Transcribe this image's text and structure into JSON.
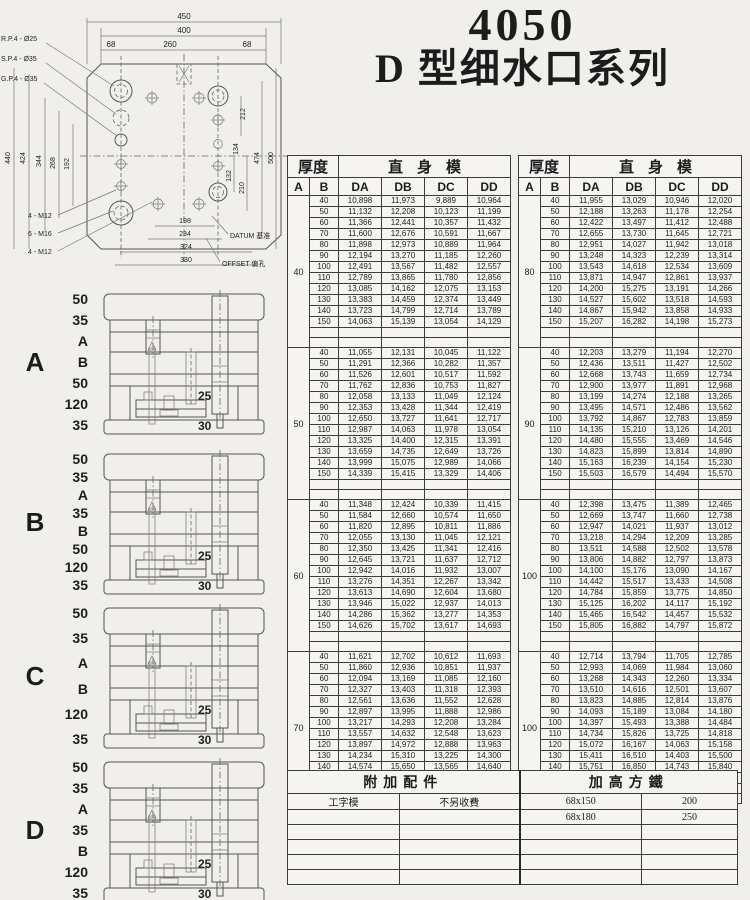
{
  "page": {
    "title_model": "4050",
    "title_series": "D 型细水口系列"
  },
  "drawing": {
    "pin_labels": [
      "R.P.4 - Ø25",
      "S.P.4 - Ø35",
      "G.P.4 - Ø35"
    ],
    "dims_top": [
      "450",
      "400",
      "68",
      "260",
      "68"
    ],
    "dims_left": [
      "440",
      "424",
      "344",
      "268",
      "192"
    ],
    "dims_right": [
      "212",
      "134",
      "132",
      "210",
      "474",
      "500"
    ],
    "dims_bottom": [
      "198",
      "234",
      "324",
      "330"
    ],
    "thread_labels": [
      "4 - M12",
      "6 - M16",
      "4 - M12"
    ],
    "label_datum": "DATUM 基准",
    "label_offset": "OFFSET 偏孔"
  },
  "sections": [
    {
      "letter": "A",
      "dims": [
        "50",
        "35",
        "A",
        "B",
        "50",
        "120",
        "35"
      ],
      "inner": [
        "25",
        "30"
      ]
    },
    {
      "letter": "B",
      "dims": [
        "50",
        "35",
        "A",
        "35",
        "B",
        "50",
        "120",
        "35"
      ],
      "inner": [
        "25",
        "30"
      ]
    },
    {
      "letter": "C",
      "dims": [
        "50",
        "35",
        "A",
        "B",
        "120",
        "35"
      ],
      "inner": [
        "25",
        "30"
      ]
    },
    {
      "letter": "D",
      "dims": [
        "50",
        "35",
        "A",
        "35",
        "B",
        "120",
        "35"
      ],
      "inner": [
        "25",
        "30"
      ]
    }
  ],
  "tables": {
    "header_thickness": "厚度",
    "header_straight": "直身模",
    "col_a": "A",
    "col_b": "B",
    "col_da": "DA",
    "col_db": "DB",
    "col_dc": "DC",
    "col_dd": "DD",
    "left_groups": [
      {
        "a": "40",
        "rows": [
          [
            "40",
            "10,898",
            "11,973",
            "9,889",
            "10,964"
          ],
          [
            "50",
            "11,132",
            "12,208",
            "10,123",
            "11,199"
          ],
          [
            "60",
            "11,366",
            "12,441",
            "10,357",
            "11,432"
          ],
          [
            "70",
            "11,600",
            "12,676",
            "10,591",
            "11,667"
          ],
          [
            "80",
            "11,898",
            "12,973",
            "10,889",
            "11,964"
          ],
          [
            "90",
            "12,194",
            "13,270",
            "11,185",
            "12,260"
          ],
          [
            "100",
            "12,491",
            "13,567",
            "11,482",
            "12,557"
          ],
          [
            "110",
            "12,789",
            "13,865",
            "11,780",
            "12,856"
          ],
          [
            "120",
            "13,085",
            "14,162",
            "12,075",
            "13,153"
          ],
          [
            "130",
            "13,383",
            "14,459",
            "12,374",
            "13,449"
          ],
          [
            "140",
            "13,723",
            "14,799",
            "12,714",
            "13,789"
          ],
          [
            "150",
            "14,063",
            "15,139",
            "13,054",
            "14,129"
          ]
        ]
      },
      {
        "a": "50",
        "rows": [
          [
            "40",
            "11,055",
            "12,131",
            "10,045",
            "11,122"
          ],
          [
            "50",
            "11,291",
            "12,366",
            "10,282",
            "11,357"
          ],
          [
            "60",
            "11,526",
            "12,601",
            "10,517",
            "11,592"
          ],
          [
            "70",
            "11,762",
            "12,836",
            "10,753",
            "11,827"
          ],
          [
            "80",
            "12,058",
            "13,133",
            "11,049",
            "12,124"
          ],
          [
            "90",
            "12,353",
            "13,428",
            "11,344",
            "12,419"
          ],
          [
            "100",
            "12,650",
            "13,727",
            "11,641",
            "12,717"
          ],
          [
            "110",
            "12,987",
            "14,063",
            "11,978",
            "13,054"
          ],
          [
            "120",
            "13,325",
            "14,400",
            "12,315",
            "13,391"
          ],
          [
            "130",
            "13,659",
            "14,735",
            "12,649",
            "13,726"
          ],
          [
            "140",
            "13,999",
            "15,075",
            "12,989",
            "14,066"
          ],
          [
            "150",
            "14,339",
            "15,415",
            "13,329",
            "14,406"
          ]
        ]
      },
      {
        "a": "60",
        "rows": [
          [
            "40",
            "11,348",
            "12,424",
            "10,339",
            "11,415"
          ],
          [
            "50",
            "11,584",
            "12,660",
            "10,574",
            "11,650"
          ],
          [
            "60",
            "11,820",
            "12,895",
            "10,811",
            "11,886"
          ],
          [
            "70",
            "12,055",
            "13,130",
            "11,045",
            "12,121"
          ],
          [
            "80",
            "12,350",
            "13,425",
            "11,341",
            "12,416"
          ],
          [
            "90",
            "12,645",
            "13,721",
            "11,637",
            "12,712"
          ],
          [
            "100",
            "12,942",
            "14,016",
            "11,932",
            "13,007"
          ],
          [
            "110",
            "13,276",
            "14,351",
            "12,267",
            "13,342"
          ],
          [
            "120",
            "13,613",
            "14,690",
            "12,604",
            "13,680"
          ],
          [
            "130",
            "13,946",
            "15,022",
            "12,937",
            "14,013"
          ],
          [
            "140",
            "14,286",
            "15,362",
            "13,277",
            "14,353"
          ],
          [
            "150",
            "14,626",
            "15,702",
            "13,617",
            "14,693"
          ]
        ]
      },
      {
        "a": "70",
        "rows": [
          [
            "40",
            "11,621",
            "12,702",
            "10,612",
            "11,693"
          ],
          [
            "50",
            "11,860",
            "12,936",
            "10,851",
            "11,937"
          ],
          [
            "60",
            "12,094",
            "13,169",
            "11,085",
            "12,160"
          ],
          [
            "70",
            "12,327",
            "13,403",
            "11,318",
            "12,393"
          ],
          [
            "80",
            "12,561",
            "13,636",
            "11,552",
            "12,628"
          ],
          [
            "90",
            "12,897",
            "13,995",
            "11,888",
            "12,986"
          ],
          [
            "100",
            "13,217",
            "14,293",
            "12,208",
            "13,284"
          ],
          [
            "110",
            "13,557",
            "14,632",
            "12,548",
            "13,623"
          ],
          [
            "120",
            "13,897",
            "14,972",
            "12,888",
            "13,963"
          ],
          [
            "130",
            "14,234",
            "15,310",
            "13,225",
            "14,300"
          ],
          [
            "140",
            "14,574",
            "15,650",
            "13,565",
            "14,640"
          ],
          [
            "150",
            "14,914",
            "15,990",
            "13,905",
            "14,980"
          ]
        ]
      }
    ],
    "right_groups": [
      {
        "a": "80",
        "rows": [
          [
            "40",
            "11,955",
            "13,029",
            "10,946",
            "12,020"
          ],
          [
            "50",
            "12,188",
            "13,263",
            "11,178",
            "12,254"
          ],
          [
            "60",
            "12,422",
            "13,497",
            "11,412",
            "12,488"
          ],
          [
            "70",
            "12,655",
            "13,730",
            "11,645",
            "12,721"
          ],
          [
            "80",
            "12,951",
            "14,027",
            "11,942",
            "13,018"
          ],
          [
            "90",
            "13,248",
            "14,323",
            "12,239",
            "13,314"
          ],
          [
            "100",
            "13,543",
            "14,618",
            "12,534",
            "13,609"
          ],
          [
            "110",
            "13,871",
            "14,947",
            "12,861",
            "13,937"
          ],
          [
            "120",
            "14,200",
            "15,275",
            "13,191",
            "14,266"
          ],
          [
            "130",
            "14,527",
            "15,602",
            "13,518",
            "14,593"
          ],
          [
            "140",
            "14,867",
            "15,942",
            "13,858",
            "14,933"
          ],
          [
            "150",
            "15,207",
            "16,282",
            "14,198",
            "15,273"
          ]
        ]
      },
      {
        "a": "90",
        "rows": [
          [
            "40",
            "12,203",
            "13,279",
            "11,194",
            "12,270"
          ],
          [
            "50",
            "12,436",
            "13,511",
            "11,427",
            "12,502"
          ],
          [
            "60",
            "12,668",
            "13,743",
            "11,659",
            "12,734"
          ],
          [
            "70",
            "12,900",
            "13,977",
            "11,891",
            "12,968"
          ],
          [
            "80",
            "13,199",
            "14,274",
            "12,188",
            "13,265"
          ],
          [
            "90",
            "13,495",
            "14,571",
            "12,486",
            "13,562"
          ],
          [
            "100",
            "13,792",
            "14,867",
            "12,783",
            "13,859"
          ],
          [
            "110",
            "14,135",
            "15,210",
            "13,126",
            "14,201"
          ],
          [
            "120",
            "14,480",
            "15,555",
            "13,469",
            "14,546"
          ],
          [
            "130",
            "14,823",
            "15,899",
            "13,814",
            "14,890"
          ],
          [
            "140",
            "15,163",
            "16,239",
            "14,154",
            "15,230"
          ],
          [
            "150",
            "15,503",
            "16,579",
            "14,494",
            "15,570"
          ]
        ]
      },
      {
        "a": "100",
        "rows": [
          [
            "40",
            "12,398",
            "13,475",
            "11,389",
            "12,465"
          ],
          [
            "50",
            "12,669",
            "13,747",
            "11,660",
            "12,738"
          ],
          [
            "60",
            "12,947",
            "14,021",
            "11,937",
            "13,012"
          ],
          [
            "70",
            "13,218",
            "14,294",
            "12,209",
            "13,285"
          ],
          [
            "80",
            "13,511",
            "14,588",
            "12,502",
            "13,578"
          ],
          [
            "90",
            "13,806",
            "14,882",
            "12,797",
            "13,873"
          ],
          [
            "100",
            "14,100",
            "15,176",
            "13,090",
            "14,167"
          ],
          [
            "110",
            "14,442",
            "15,517",
            "13,433",
            "14,508"
          ],
          [
            "120",
            "14,784",
            "15,859",
            "13,775",
            "14,850"
          ],
          [
            "130",
            "15,125",
            "16,202",
            "14,117",
            "15,192"
          ],
          [
            "140",
            "15,465",
            "16,542",
            "14,457",
            "15,532"
          ],
          [
            "150",
            "15,805",
            "16,882",
            "14,797",
            "15,872"
          ]
        ]
      },
      {
        "a": "100",
        "rows": [
          [
            "40",
            "12,714",
            "13,794",
            "11,705",
            "12,785"
          ],
          [
            "50",
            "12,993",
            "14,069",
            "11,984",
            "13,060"
          ],
          [
            "60",
            "13,268",
            "14,343",
            "12,260",
            "13,334"
          ],
          [
            "70",
            "13,510",
            "14,616",
            "12,501",
            "13,607"
          ],
          [
            "80",
            "13,823",
            "14,885",
            "12,814",
            "13,876"
          ],
          [
            "90",
            "14,093",
            "15,189",
            "13,084",
            "14,180"
          ],
          [
            "100",
            "14,397",
            "15,493",
            "13,388",
            "14,484"
          ],
          [
            "110",
            "14,734",
            "15,826",
            "13,725",
            "14,818"
          ],
          [
            "120",
            "15,072",
            "16,167",
            "14,063",
            "15,158"
          ],
          [
            "130",
            "15,411",
            "16,510",
            "14,403",
            "15,500"
          ],
          [
            "140",
            "15,751",
            "16,850",
            "14,743",
            "15,840"
          ],
          [
            "150",
            "16,091",
            "17,190",
            "15,083",
            "16,180"
          ]
        ]
      }
    ]
  },
  "accessory_table": {
    "header_left": "附加配件",
    "header_right": "加高方鐵",
    "rows": [
      [
        "工字模",
        "不另收費",
        "68x150",
        "200"
      ],
      [
        "",
        "",
        "68x180",
        "250"
      ],
      [
        "",
        "",
        "",
        ""
      ],
      [
        "",
        "",
        "",
        ""
      ],
      [
        "",
        "",
        "",
        ""
      ],
      [
        "",
        "",
        "",
        ""
      ]
    ]
  }
}
